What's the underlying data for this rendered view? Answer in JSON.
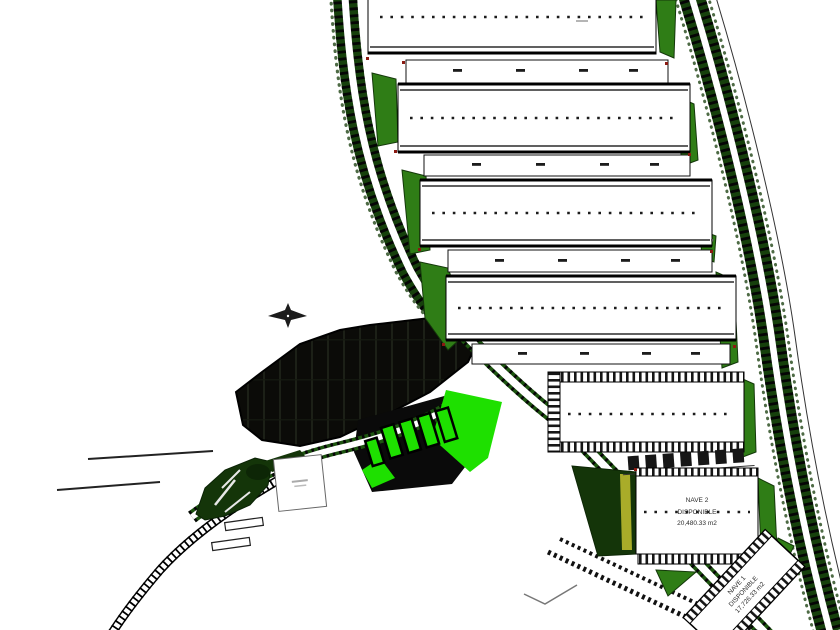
{
  "labels": {
    "nave2": {
      "name": "NAVE 2",
      "status": "DISPONIBLE",
      "area": "20,480.33 m2"
    },
    "nave1": {
      "name": "NAVE 1",
      "status": "DISPONIBLE",
      "area": "17,726.33 m2"
    }
  },
  "colors": {
    "background": "#ffffff",
    "tree_strip_green": "#16400c",
    "road_white": "#ffffff",
    "green_patch": "#2f7d16",
    "dark_green": "#143509",
    "bright_green": "#1ee000",
    "dark_zone": "#0b0b08",
    "outline_black": "#000000",
    "hydrant_red": "#8b1a12",
    "accent_yellow": "#b9b92e",
    "label_text": "#2b2b2b"
  },
  "icons": {
    "north_arrow": "north-arrow-icon"
  }
}
